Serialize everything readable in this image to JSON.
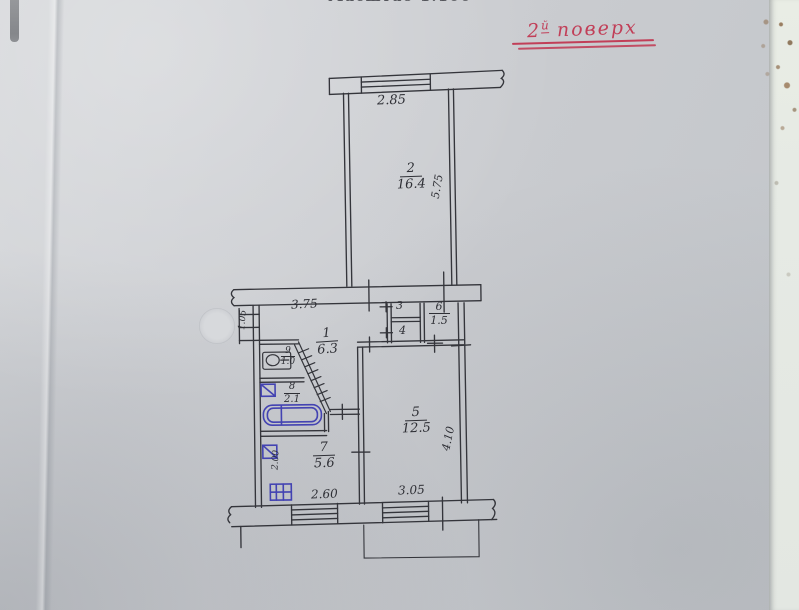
{
  "header": {
    "scale_note": "Масштаб 1:100",
    "floor_note_num": "2",
    "floor_note_sup": "й",
    "floor_note_word": " поверх"
  },
  "rooms": {
    "room1": {
      "number": "1",
      "area": "6.3"
    },
    "room2": {
      "number": "2",
      "area": "16.4"
    },
    "room3": {
      "number": "3"
    },
    "room4": {
      "number": "4"
    },
    "room5": {
      "number": "5",
      "area": "12.5"
    },
    "room6": {
      "number": "6",
      "area": "1.5"
    },
    "room7": {
      "number": "7",
      "area": "5.6"
    },
    "room8": {
      "number": "8",
      "area": "2.1"
    },
    "room9": {
      "number": "9",
      "area": "1.0"
    }
  },
  "dimensions": {
    "room2_width": "2.85",
    "room2_depth": "5.75",
    "hallway_width": "3.75",
    "entry_wall": "1.05",
    "room5_depth": "4.10",
    "room5_width": "3.05",
    "kitchen_width": "2.60",
    "kitchen_wall": "2.00"
  },
  "icons": {
    "washbasin": "washbasin-icon",
    "bathtub": "bathtub-icon",
    "stove": "stove-icon",
    "bath_sink": "sink-icon",
    "kitchen_sink": "sink-icon",
    "windows": "window-icon",
    "hatched_partition": "hatched-partition-icon"
  },
  "colors": {
    "ink": "#34353b",
    "blue_ink": "#4343b2",
    "red_ink": "#c13f58",
    "paper": "#cbced2"
  }
}
